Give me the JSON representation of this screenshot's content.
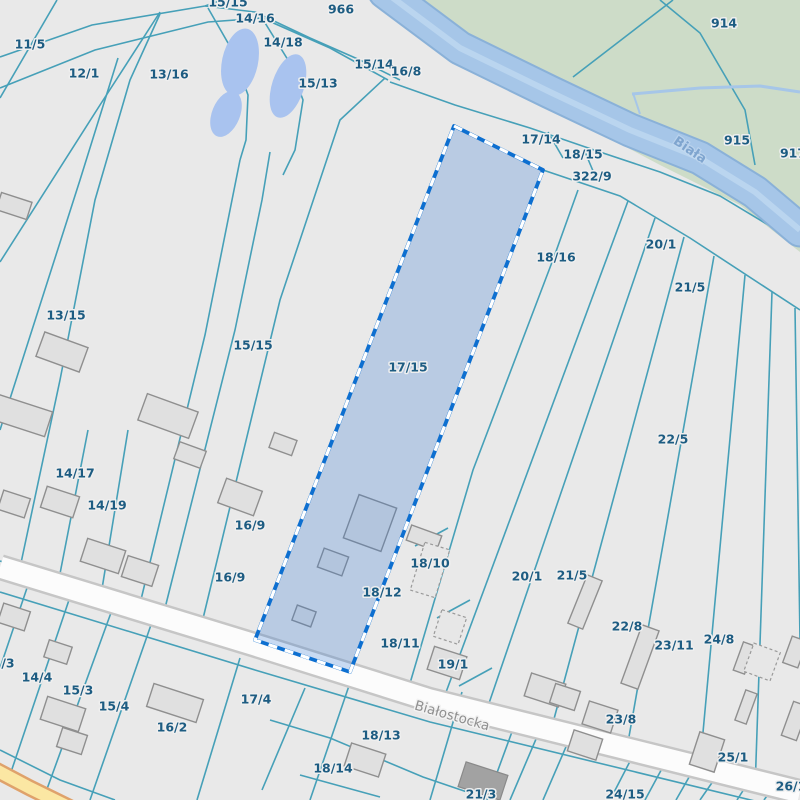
{
  "map": {
    "colors": {
      "background": "#e9e9e9",
      "boundary_line": "#46a0b8",
      "parcel_label": "#1d5c82",
      "green_area": "#cddcc8",
      "river_fill": "#a6c6e8",
      "river_bank": "#8ab1d8",
      "river_streak": "#bad5ef",
      "pond_fill": "#a9c3ef",
      "road_fill": "#fcfcfc",
      "road_casing": "#c6c6c6",
      "yellow_road_fill": "#fbe7a3",
      "yellow_road_casing": "#dfa26b",
      "street_label": "#8f8f8f",
      "river_label": "#7fa5cf",
      "building_fill": "#e0e0e0",
      "building_stroke": "#8f8f8f",
      "building_dark_fill": "#a2a2a2",
      "highlight_fill": "rgba(45,115,210,0.25)",
      "highlight_border": "#0d6fd0",
      "highlight_dash": "#ffffff"
    },
    "highlighted_parcel": {
      "label": "17/15",
      "points": [
        [
          454,
          126
        ],
        [
          543,
          170
        ],
        [
          350,
          672
        ],
        [
          255,
          640
        ]
      ]
    },
    "parcel_labels": [
      {
        "t": "15/15",
        "x": 228,
        "y": 2
      },
      {
        "t": "966",
        "x": 341,
        "y": 9
      },
      {
        "t": "14/16",
        "x": 255,
        "y": 18
      },
      {
        "t": "11/5",
        "x": 30,
        "y": 44
      },
      {
        "t": "14/18",
        "x": 283,
        "y": 42
      },
      {
        "t": "12/1",
        "x": 84,
        "y": 73
      },
      {
        "t": "13/16",
        "x": 169,
        "y": 74
      },
      {
        "t": "15/14",
        "x": 374,
        "y": 64
      },
      {
        "t": "16/8",
        "x": 406,
        "y": 71
      },
      {
        "t": "15/13",
        "x": 318,
        "y": 83
      },
      {
        "t": "914",
        "x": 724,
        "y": 23
      },
      {
        "t": "915",
        "x": 737,
        "y": 140
      },
      {
        "t": "917",
        "x": 793,
        "y": 153
      },
      {
        "t": "17/14",
        "x": 541,
        "y": 139
      },
      {
        "t": "18/15",
        "x": 583,
        "y": 154
      },
      {
        "t": "322/9",
        "x": 592,
        "y": 176
      },
      {
        "t": "18/16",
        "x": 556,
        "y": 257
      },
      {
        "t": "20/1",
        "x": 661,
        "y": 244
      },
      {
        "t": "21/5",
        "x": 690,
        "y": 287
      },
      {
        "t": "13/15",
        "x": 66,
        "y": 315
      },
      {
        "t": "15/15",
        "x": 253,
        "y": 345
      },
      {
        "t": "17/15",
        "x": 408,
        "y": 367
      },
      {
        "t": "22/5",
        "x": 673,
        "y": 439
      },
      {
        "t": "14/17",
        "x": 75,
        "y": 473
      },
      {
        "t": "14/19",
        "x": 107,
        "y": 505
      },
      {
        "t": "16/9",
        "x": 250,
        "y": 525
      },
      {
        "t": "16/9",
        "x": 230,
        "y": 577
      },
      {
        "t": "18/10",
        "x": 430,
        "y": 563
      },
      {
        "t": "20/1",
        "x": 527,
        "y": 576
      },
      {
        "t": "21/5",
        "x": 572,
        "y": 575
      },
      {
        "t": "18/12",
        "x": 382,
        "y": 592
      },
      {
        "t": "22/8",
        "x": 627,
        "y": 626
      },
      {
        "t": "23/11",
        "x": 674,
        "y": 645
      },
      {
        "t": "24/8",
        "x": 719,
        "y": 639
      },
      {
        "t": "18/11",
        "x": 400,
        "y": 643
      },
      {
        "t": "/3",
        "x": 8,
        "y": 663
      },
      {
        "t": "19/1",
        "x": 453,
        "y": 664
      },
      {
        "t": "14/4",
        "x": 37,
        "y": 677
      },
      {
        "t": "15/3",
        "x": 78,
        "y": 690
      },
      {
        "t": "15/4",
        "x": 114,
        "y": 706
      },
      {
        "t": "16/2",
        "x": 172,
        "y": 727
      },
      {
        "t": "17/4",
        "x": 256,
        "y": 699
      },
      {
        "t": "23/8",
        "x": 621,
        "y": 719
      },
      {
        "t": "18/13",
        "x": 381,
        "y": 735
      },
      {
        "t": "25/1",
        "x": 733,
        "y": 757
      },
      {
        "t": "18/14",
        "x": 333,
        "y": 768
      },
      {
        "t": "26/1",
        "x": 791,
        "y": 786
      },
      {
        "t": "21/3",
        "x": 481,
        "y": 794
      },
      {
        "t": "24/15",
        "x": 625,
        "y": 794
      }
    ],
    "street_label": {
      "t": "Białostocka",
      "x": 452,
      "y": 716,
      "rot": 16
    },
    "river_label": {
      "t": "Biała",
      "x": 690,
      "y": 150,
      "rot": 34
    },
    "green_area": [
      [
        388,
        0
      ],
      [
        800,
        0
      ],
      [
        800,
        252
      ],
      [
        740,
        205
      ],
      [
        660,
        165
      ],
      [
        560,
        112
      ],
      [
        470,
        62
      ],
      [
        420,
        18
      ]
    ],
    "river_centerline": [
      [
        385,
        -8
      ],
      [
        460,
        48
      ],
      [
        550,
        92
      ],
      [
        630,
        130
      ],
      [
        700,
        158
      ],
      [
        755,
        192
      ],
      [
        800,
        230
      ]
    ],
    "channel": [
      [
        632,
        94
      ],
      [
        700,
        88
      ],
      [
        760,
        86
      ],
      [
        800,
        92
      ]
    ],
    "channel_stub": [
      [
        633,
        93
      ],
      [
        640,
        114
      ]
    ],
    "ponds": [
      {
        "cx": 240,
        "cy": 62,
        "rx": 18,
        "ry": 34,
        "rot": 12
      },
      {
        "cx": 226,
        "cy": 114,
        "rx": 14,
        "ry": 24,
        "rot": 22
      },
      {
        "cx": 288,
        "cy": 86,
        "rx": 16,
        "ry": 33,
        "rot": 18
      }
    ],
    "road_white": [
      [
        0,
        567
      ],
      [
        255,
        645
      ],
      [
        430,
        700
      ],
      [
        800,
        792
      ]
    ],
    "road_yellow": [
      [
        -8,
        768
      ],
      [
        30,
        788
      ],
      [
        85,
        815
      ]
    ],
    "boundary_lines": [
      [
        0,
        98,
        57,
        0
      ],
      [
        0,
        262,
        100,
        105,
        160,
        12
      ],
      [
        0,
        430,
        80,
        180,
        118,
        58
      ],
      [
        18,
        577,
        60,
        380,
        95,
        200,
        130,
        80,
        160,
        14
      ],
      [
        57,
        589,
        88,
        430
      ],
      [
        100,
        601,
        128,
        430
      ],
      [
        138,
        612,
        205,
        335,
        240,
        160
      ],
      [
        162,
        620,
        235,
        330,
        262,
        200,
        270,
        152
      ],
      [
        200,
        631,
        280,
        300,
        340,
        120,
        385,
        78
      ],
      [
        0,
        57,
        92,
        25,
        205,
        6,
        222,
        0
      ],
      [
        0,
        88,
        95,
        50,
        208,
        22,
        262,
        18,
        330,
        48,
        388,
        80
      ],
      [
        205,
        6,
        255,
        12,
        310,
        38,
        360,
        60,
        400,
        80
      ],
      [
        208,
        8,
        232,
        50,
        248,
        95,
        246,
        140,
        240,
        160
      ],
      [
        262,
        18,
        288,
        60,
        303,
        100,
        295,
        150,
        283,
        175
      ],
      [
        390,
        82,
        455,
        105,
        530,
        128,
        600,
        152,
        660,
        172,
        720,
        196,
        800,
        244
      ],
      [
        454,
        126,
        543,
        170,
        620,
        196,
        690,
        238,
        800,
        310
      ],
      [
        548,
        132,
        563,
        158
      ],
      [
        585,
        152,
        596,
        178
      ],
      [
        408,
        690,
        473,
        470,
        554,
        257,
        578,
        190
      ],
      [
        442,
        703,
        628,
        201
      ],
      [
        486,
        712,
        655,
        218
      ],
      [
        551,
        730,
        684,
        237
      ],
      [
        627,
        748,
        714,
        256
      ],
      [
        700,
        765,
        745,
        275
      ],
      [
        755,
        790,
        772,
        292
      ],
      [
        800,
        640,
        795,
        308
      ],
      [
        448,
        528,
        415,
        546
      ],
      [
        470,
        600,
        437,
        618
      ],
      [
        492,
        668,
        459,
        686
      ],
      [
        573,
        77,
        673,
        0
      ],
      [
        660,
        0,
        700,
        33,
        745,
        110,
        755,
        165
      ],
      [
        0,
        750,
        60,
        780,
        115,
        800
      ],
      [
        28,
        585,
        0,
        668
      ],
      [
        70,
        597,
        10,
        775
      ],
      [
        112,
        610,
        43,
        800
      ],
      [
        152,
        622,
        90,
        800
      ],
      [
        240,
        658,
        197,
        800
      ],
      [
        305,
        688,
        262,
        790
      ],
      [
        352,
        677,
        310,
        800
      ],
      [
        270,
        720,
        330,
        738,
        423,
        777,
        470,
        793
      ],
      [
        300,
        775,
        380,
        797
      ],
      [
        462,
        692,
        430,
        800
      ],
      [
        520,
        710,
        487,
        800
      ],
      [
        545,
        718,
        510,
        800
      ],
      [
        575,
        726,
        543,
        800
      ],
      [
        640,
        742,
        610,
        800
      ],
      [
        672,
        750,
        645,
        800
      ],
      [
        700,
        758,
        676,
        800
      ],
      [
        725,
        764,
        700,
        800
      ],
      [
        755,
        772,
        737,
        800
      ],
      [
        780,
        778,
        764,
        800
      ],
      [
        0,
        561,
        255,
        638,
        352,
        677
      ],
      [
        0,
        592,
        255,
        670,
        430,
        722,
        800,
        812
      ]
    ],
    "buildings": [
      [
        14,
        206,
        32,
        18,
        18,
        0
      ],
      [
        20,
        415,
        60,
        26,
        18,
        0
      ],
      [
        62,
        352,
        46,
        26,
        20,
        0
      ],
      [
        168,
        416,
        54,
        28,
        20,
        0
      ],
      [
        190,
        455,
        28,
        18,
        20,
        0
      ],
      [
        14,
        504,
        28,
        20,
        18,
        0
      ],
      [
        60,
        502,
        34,
        22,
        18,
        0
      ],
      [
        103,
        556,
        40,
        24,
        18,
        0
      ],
      [
        140,
        571,
        32,
        22,
        18,
        0
      ],
      [
        240,
        497,
        38,
        26,
        20,
        0
      ],
      [
        283,
        444,
        24,
        16,
        20,
        0
      ],
      [
        370,
        523,
        40,
        46,
        20,
        0
      ],
      [
        333,
        562,
        26,
        20,
        20,
        0
      ],
      [
        304,
        616,
        20,
        16,
        20,
        0
      ],
      [
        424,
        538,
        32,
        16,
        20,
        0
      ],
      [
        430,
        570,
        26,
        50,
        17,
        1
      ],
      [
        447,
        663,
        34,
        24,
        18,
        0
      ],
      [
        450,
        627,
        26,
        28,
        18,
        1
      ],
      [
        545,
        690,
        36,
        24,
        18,
        0
      ],
      [
        585,
        602,
        16,
        52,
        22,
        0
      ],
      [
        640,
        657,
        18,
        62,
        20,
        0
      ],
      [
        600,
        717,
        30,
        24,
        18,
        0
      ],
      [
        565,
        697,
        26,
        20,
        18,
        0
      ],
      [
        744,
        658,
        12,
        30,
        20,
        0
      ],
      [
        762,
        662,
        28,
        30,
        20,
        1
      ],
      [
        746,
        707,
        12,
        32,
        20,
        0
      ],
      [
        707,
        752,
        26,
        34,
        18,
        0
      ],
      [
        795,
        721,
        16,
        36,
        20,
        0
      ],
      [
        483,
        781,
        44,
        26,
        18,
        2
      ],
      [
        585,
        745,
        30,
        22,
        18,
        0
      ],
      [
        14,
        617,
        28,
        20,
        18,
        0
      ],
      [
        58,
        652,
        24,
        18,
        18,
        0
      ],
      [
        63,
        714,
        40,
        24,
        18,
        0
      ],
      [
        72,
        741,
        26,
        20,
        18,
        0
      ],
      [
        175,
        703,
        52,
        24,
        18,
        0
      ],
      [
        365,
        760,
        36,
        24,
        18,
        0
      ],
      [
        795,
        652,
        16,
        28,
        20,
        0
      ]
    ]
  }
}
